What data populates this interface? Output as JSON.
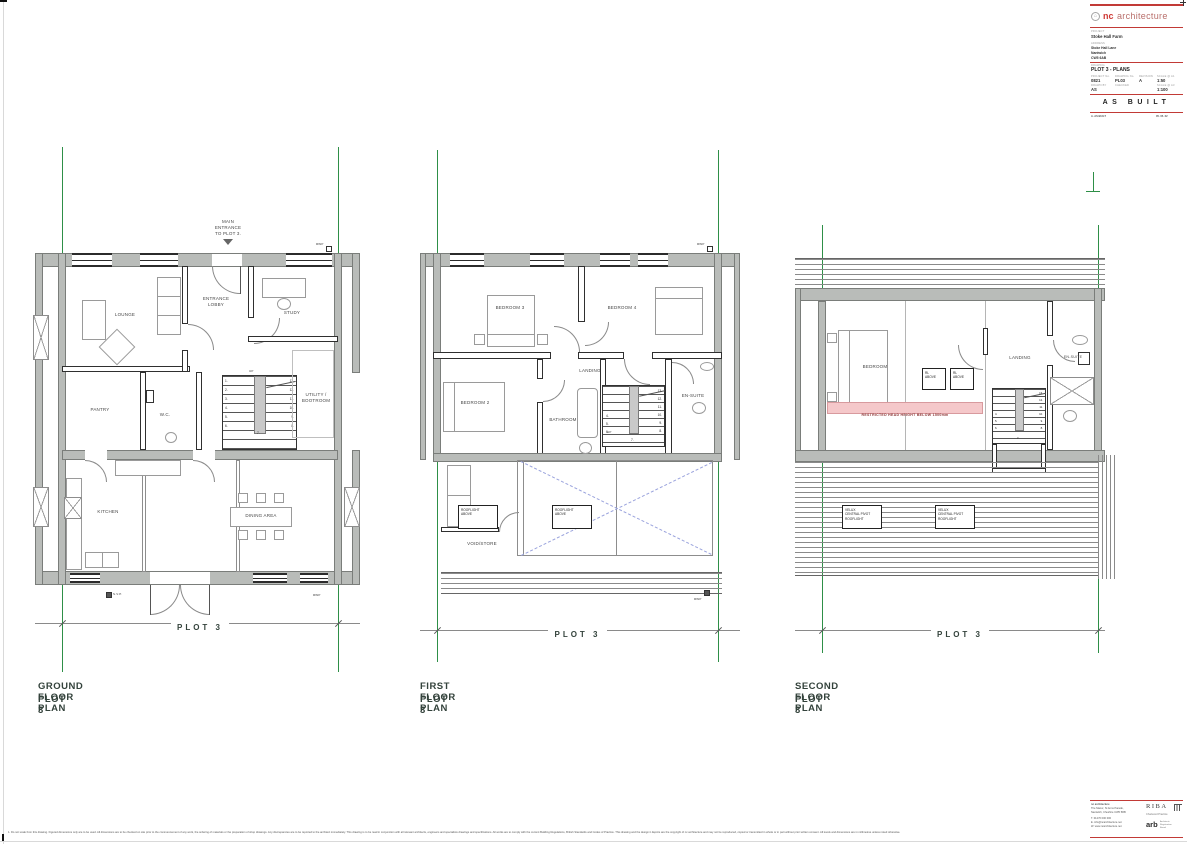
{
  "sheet": {
    "disclaimer": "1. Do not scale from this drawing. Figured dimensions only are to be used. All dimensions are to be checked on site prior to the commencement of any work, the ordering of materials or the preparation of shop drawings. Any discrepancies are to be reported to the architect immediately. This drawing is to be read in conjunction with all relevant architects, engineers and specialists drawings and specifications. All works are to comply with the current Building Regulations, British Standards and Codes of Practice. This drawing and the design it depicts are the copyright of nc architecture and may not be reproduced, copied or transmitted in whole or in part without prior written consent. All levels and dimensions are in millimetres unless noted otherwise."
  },
  "title_block": {
    "logo_nc": "nc",
    "logo_firm": "architecture",
    "project_label": "PROJECT",
    "project": "Stoke Hall Farm",
    "address_label": "ADDRESS",
    "address1": "Stoke Hall Lane",
    "address2": "Nantwich",
    "address3": "CW5 6AB",
    "drawing_label": "DRAWING",
    "drawing": "PLOT 3 - PLANS",
    "f1_label": "PROJECT No.",
    "f1": "0821",
    "f2_label": "DRAWING No.",
    "f2": "PL03",
    "f3_label": "REVISION",
    "f3": "A",
    "f4_label": "SCALE @ A1",
    "f4": "1:50",
    "f5_label": "DRAWN BY",
    "f5": "AS",
    "f6_label": "CHECKED",
    "f6": "",
    "f7_label": "SCALE @ A3",
    "f7": "1:100",
    "status": "AS BUILT",
    "rev_left": "A.  AS BUILT",
    "rev_right": "05. 05. 22"
  },
  "contact": {
    "l1": "nc architecture",
    "l2": "The Manor, St Anns Parade,",
    "l3": "Nantwich, Cheshire CW5 5RB",
    "l4": "T.  01270 000 000",
    "l5": "E.  info@ncarchitecture.net",
    "l6": "W. www.ncarchitecture.net",
    "riba": "RIBA",
    "riba_sub": "Chartered Practice",
    "arb": "arb",
    "arb_sub": "Architects\nRegistration\nBoard"
  },
  "plans": {
    "ground": {
      "caption1": "GROUND FLOOR PLAN",
      "caption2": "PLOT 3",
      "dim": "PLOT 3",
      "entrance_note": "MAIN\nENTRANCE\nTO PLOT 3.",
      "lounge": "LOUNGE",
      "lobby": "ENTRANCE\nLOBBY",
      "study": "STUDY",
      "pantry": "PANTRY",
      "wc": "W.C.",
      "utility": "UTILITY /\nBOOTROOM",
      "kitchen": "KITCHEN",
      "dining": "DINING AREA",
      "rwp_top": "RWP",
      "rwp_bottom": "RWP",
      "svp": "S.V.P.",
      "up": "UP",
      "stair_left": "1.\n2.\n3.\n4.\n5.\n6.",
      "stair_right": "13.\n12.\n11.\n10.\n9.\n8.",
      "stair_mid": "7."
    },
    "first": {
      "caption1": "FIRST FLOOR PLAN",
      "caption2": "PLOT 3",
      "dim": "PLOT 3",
      "bedroom3": "BEDROOM 3",
      "bedroom4": "BEDROOM 4",
      "bedroom2": "BEDROOM 2",
      "landing": "LANDING",
      "bathroom": "BATHROOM",
      "ensuite": "EN-SUITE",
      "rooflight1": "ROOFLIGHT\nABOVE",
      "rooflight2": "ROOFLIGHT\nABOVE",
      "void": "VOID/STORE",
      "rwp_top": "RWP",
      "rwp_bottom": "RWP",
      "up": "UP",
      "stair_left": "4.\n5.\n6.",
      "stair_right": "13.\n12.\n11.\n10.\n9.\n8.",
      "stair_mid": "7."
    },
    "second": {
      "caption1": "SECOND FLOOR PLAN",
      "caption2": "PLOT 3",
      "dim": "PLOT 3",
      "bedroom": "BEDROOM",
      "landing": "LANDING",
      "ensuite": "EN-SUITE",
      "rl1": "RL\nABOVE",
      "rl2": "RL\nABOVE",
      "velux1": "VELUX\nCENTRAL PIVOT\nROOFLIGHT",
      "velux2": "VELUX\nCENTRAL PIVOT\nROOFLIGHT",
      "restricted": "RESTRICTED HEAD HEIGHT BELOW 1500mm",
      "stair_left": "4.\n5.\n6.",
      "stair_right": "13.\n12.\n11.\n10.\n9.\n8.",
      "stair_mid": "7."
    }
  }
}
